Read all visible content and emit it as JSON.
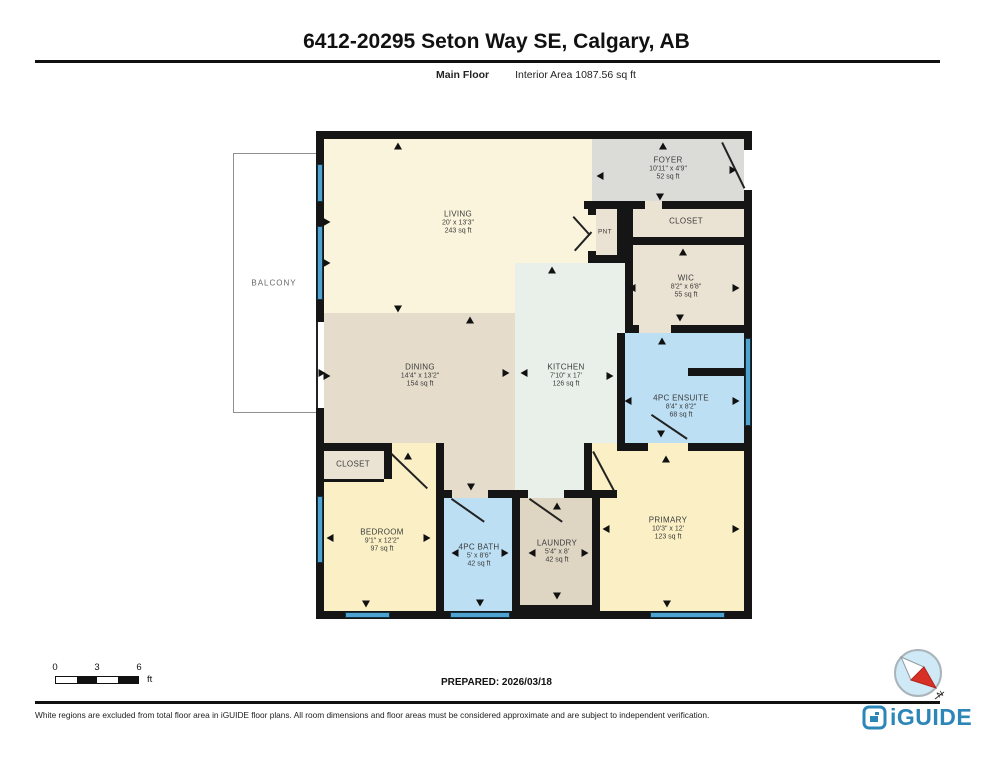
{
  "header": {
    "title": "6412-20295 Seton Way SE, Calgary, AB",
    "floor_label": "Main Floor",
    "area_label": "Interior Area 1087.56 sq ft"
  },
  "floorplan": {
    "rooms": {
      "living": {
        "name": "LIVING",
        "dims": "20' x 13'3\"",
        "area": "243 sq ft"
      },
      "foyer": {
        "name": "FOYER",
        "dims": "10'11\" x 4'9\"",
        "area": "52 sq ft"
      },
      "pnt": {
        "name": "PNT"
      },
      "closet_top": {
        "name": "CLOSET"
      },
      "wic": {
        "name": "WIC",
        "dims": "8'2\" x 6'8\"",
        "area": "55 sq ft"
      },
      "kitchen": {
        "name": "KITCHEN",
        "dims": "7'10\" x 17'",
        "area": "126 sq ft"
      },
      "dining": {
        "name": "DINING",
        "dims": "14'4\" x 13'2\"",
        "area": "154 sq ft"
      },
      "ensuite": {
        "name": "4PC ENSUITE",
        "dims": "8'4\" x 8'2\"",
        "area": "68 sq ft"
      },
      "primary": {
        "name": "PRIMARY",
        "dims": "10'3\" x 12'",
        "area": "123 sq ft"
      },
      "laundry": {
        "name": "LAUNDRY",
        "dims": "5'4\" x 8'",
        "area": "42 sq ft"
      },
      "bath": {
        "name": "4PC BATH",
        "dims": "5' x 8'6\"",
        "area": "42 sq ft"
      },
      "bedroom": {
        "name": "BEDROOM",
        "dims": "9'1\" x 12'2\"",
        "area": "97 sq ft"
      },
      "closet_bottom": {
        "name": "CLOSET"
      },
      "balcony": {
        "name": "BALCONY"
      }
    },
    "colors": {
      "living_cream": "#FAF4DC",
      "foyer_gray": "#DBDBD8",
      "dining_tan": "#E5DCCB",
      "closet_tan": "#EAE2D2",
      "laundry_tan": "#DED5C3",
      "kitchen_mint": "#E9F0E9",
      "bedroom_yellow": "#FBF0C5",
      "bath_blue": "#BCDFF4",
      "window_blue": "#4FA3D1",
      "wall_black": "#151515",
      "logo_blue": "#2C86B8",
      "compass_red": "#D93025"
    },
    "geometry": {
      "walls": [
        {
          "x": 584,
          "y": 201,
          "w": 61,
          "h": 8
        },
        {
          "x": 662,
          "y": 201,
          "w": 82,
          "h": 8
        },
        {
          "x": 588,
          "y": 201,
          "w": 8,
          "h": 14
        },
        {
          "x": 588,
          "y": 251,
          "w": 8,
          "h": 12
        },
        {
          "x": 617,
          "y": 209,
          "w": 8,
          "h": 54
        },
        {
          "x": 588,
          "y": 255,
          "w": 37,
          "h": 8
        },
        {
          "x": 625,
          "y": 209,
          "w": 8,
          "h": 124
        },
        {
          "x": 625,
          "y": 237,
          "w": 119,
          "h": 8
        },
        {
          "x": 625,
          "y": 325,
          "w": 14,
          "h": 8
        },
        {
          "x": 671,
          "y": 325,
          "w": 73,
          "h": 8
        },
        {
          "x": 617,
          "y": 333,
          "w": 8,
          "h": 118
        },
        {
          "x": 688,
          "y": 368,
          "w": 56,
          "h": 8
        },
        {
          "x": 625,
          "y": 443,
          "w": 23,
          "h": 8
        },
        {
          "x": 688,
          "y": 443,
          "w": 56,
          "h": 8
        },
        {
          "x": 584,
          "y": 443,
          "w": 8,
          "h": 55
        },
        {
          "x": 592,
          "y": 490,
          "w": 8,
          "h": 121
        },
        {
          "x": 436,
          "y": 490,
          "w": 16,
          "h": 8
        },
        {
          "x": 488,
          "y": 490,
          "w": 40,
          "h": 8
        },
        {
          "x": 564,
          "y": 490,
          "w": 53,
          "h": 8
        },
        {
          "x": 436,
          "y": 443,
          "w": 8,
          "h": 168
        },
        {
          "x": 512,
          "y": 490,
          "w": 8,
          "h": 121
        },
        {
          "x": 316,
          "y": 443,
          "w": 76,
          "h": 8
        },
        {
          "x": 384,
          "y": 451,
          "w": 8,
          "h": 28
        },
        {
          "x": 324,
          "y": 479,
          "w": 60,
          "h": 3
        },
        {
          "x": 520,
          "y": 605,
          "w": 72,
          "h": 6
        }
      ],
      "gaps": [
        {
          "x": 744,
          "y": 150,
          "w": 8,
          "h": 40
        },
        {
          "x": 316,
          "y": 322,
          "w": 8,
          "h": 86
        }
      ],
      "windows": [
        {
          "x": 317,
          "y": 164,
          "w": 6,
          "h": 38
        },
        {
          "x": 317,
          "y": 226,
          "w": 6,
          "h": 74
        },
        {
          "x": 317,
          "y": 496,
          "w": 6,
          "h": 67
        },
        {
          "x": 345,
          "y": 612,
          "w": 45,
          "h": 6
        },
        {
          "x": 450,
          "y": 612,
          "w": 60,
          "h": 6
        },
        {
          "x": 650,
          "y": 612,
          "w": 75,
          "h": 6
        },
        {
          "x": 745,
          "y": 338,
          "w": 6,
          "h": 88
        }
      ],
      "doors": [
        {
          "x": 723,
          "y": 142,
          "len": 51,
          "deg": 64
        },
        {
          "x": 392,
          "y": 453,
          "len": 50,
          "deg": 44
        },
        {
          "x": 594,
          "y": 451,
          "len": 44,
          "deg": 62
        },
        {
          "x": 452,
          "y": 498,
          "len": 40,
          "deg": 35
        },
        {
          "x": 530,
          "y": 498,
          "len": 40,
          "deg": 35
        },
        {
          "x": 652,
          "y": 414,
          "len": 43,
          "deg": 34
        },
        {
          "x": 574,
          "y": 216,
          "len": 25,
          "deg": 48
        },
        {
          "x": 574,
          "y": 250,
          "len": 25,
          "deg": -48
        },
        {
          "x": 318,
          "y": 322,
          "len": 86,
          "deg": 90
        }
      ],
      "arrows": [
        {
          "x": 398,
          "y": 146,
          "d": "up"
        },
        {
          "x": 663,
          "y": 146,
          "d": "up"
        },
        {
          "x": 600,
          "y": 176,
          "d": "left"
        },
        {
          "x": 660,
          "y": 197,
          "d": "down"
        },
        {
          "x": 733,
          "y": 170,
          "d": "right"
        },
        {
          "x": 327,
          "y": 222,
          "d": "right"
        },
        {
          "x": 327,
          "y": 263,
          "d": "right"
        },
        {
          "x": 322,
          "y": 373,
          "d": "right"
        },
        {
          "x": 398,
          "y": 309,
          "d": "down"
        },
        {
          "x": 470,
          "y": 320,
          "d": "up"
        },
        {
          "x": 552,
          "y": 270,
          "d": "up"
        },
        {
          "x": 610,
          "y": 376,
          "d": "right"
        },
        {
          "x": 327,
          "y": 376,
          "d": "right"
        },
        {
          "x": 506,
          "y": 373,
          "d": "right"
        },
        {
          "x": 524,
          "y": 373,
          "d": "left"
        },
        {
          "x": 683,
          "y": 252,
          "d": "up"
        },
        {
          "x": 632,
          "y": 288,
          "d": "left"
        },
        {
          "x": 736,
          "y": 288,
          "d": "right"
        },
        {
          "x": 680,
          "y": 318,
          "d": "down"
        },
        {
          "x": 662,
          "y": 341,
          "d": "up"
        },
        {
          "x": 628,
          "y": 401,
          "d": "left"
        },
        {
          "x": 736,
          "y": 401,
          "d": "right"
        },
        {
          "x": 661,
          "y": 434,
          "d": "down"
        },
        {
          "x": 666,
          "y": 459,
          "d": "up"
        },
        {
          "x": 606,
          "y": 529,
          "d": "left"
        },
        {
          "x": 736,
          "y": 529,
          "d": "right"
        },
        {
          "x": 667,
          "y": 604,
          "d": "down"
        },
        {
          "x": 408,
          "y": 456,
          "d": "up"
        },
        {
          "x": 330,
          "y": 538,
          "d": "left"
        },
        {
          "x": 427,
          "y": 538,
          "d": "right"
        },
        {
          "x": 366,
          "y": 604,
          "d": "down"
        },
        {
          "x": 471,
          "y": 487,
          "d": "down"
        },
        {
          "x": 455,
          "y": 553,
          "d": "left"
        },
        {
          "x": 505,
          "y": 553,
          "d": "right"
        },
        {
          "x": 480,
          "y": 603,
          "d": "down"
        },
        {
          "x": 557,
          "y": 506,
          "d": "up"
        },
        {
          "x": 532,
          "y": 553,
          "d": "left"
        },
        {
          "x": 585,
          "y": 553,
          "d": "right"
        },
        {
          "x": 557,
          "y": 596,
          "d": "down"
        }
      ]
    }
  },
  "footer": {
    "scale": {
      "zero": "0",
      "three": "3",
      "six": "6",
      "unit": "ft"
    },
    "prepared": "PREPARED: 2026/03/18",
    "compass_n": "N",
    "disclaimer": "White regions are excluded from total floor area in iGUIDE floor plans. All room dimensions and floor areas must be considered approximate and are subject to independent verification.",
    "logo_text": "iGUIDE"
  }
}
